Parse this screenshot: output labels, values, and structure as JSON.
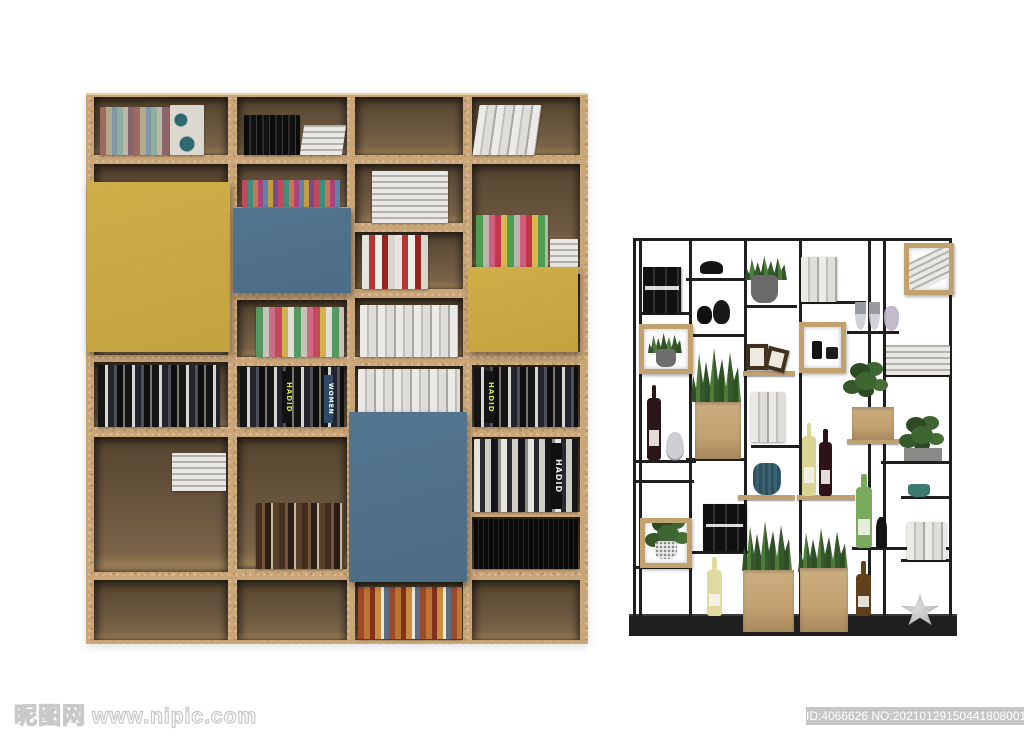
{
  "watermark": {
    "site_name": "昵图网",
    "site_url": "www.nipic.com",
    "id_text": "ID:4066626 NO:20210129150441808001"
  },
  "book_spines": {
    "hadid": "HADID",
    "women": "WOMEN"
  },
  "colors": {
    "background": "#ffffff",
    "wood": "#c9a577",
    "wood_light": "#e6cfa6",
    "cell_dark": "#55442f",
    "cell_mid": "#6b5740",
    "cell_floor": "#9c8157",
    "panel_yellow": "#cfae48",
    "panel_blue": "#54758f",
    "metal": "#1f1f1f",
    "planter": "#c2a171",
    "leaf": "#3f6632",
    "leaf_dark": "#2d4b22",
    "id_badge_bg": "#c6c6c6",
    "id_badge_text": "#ffffff",
    "watermark_stroke": "#c9c9c9"
  }
}
